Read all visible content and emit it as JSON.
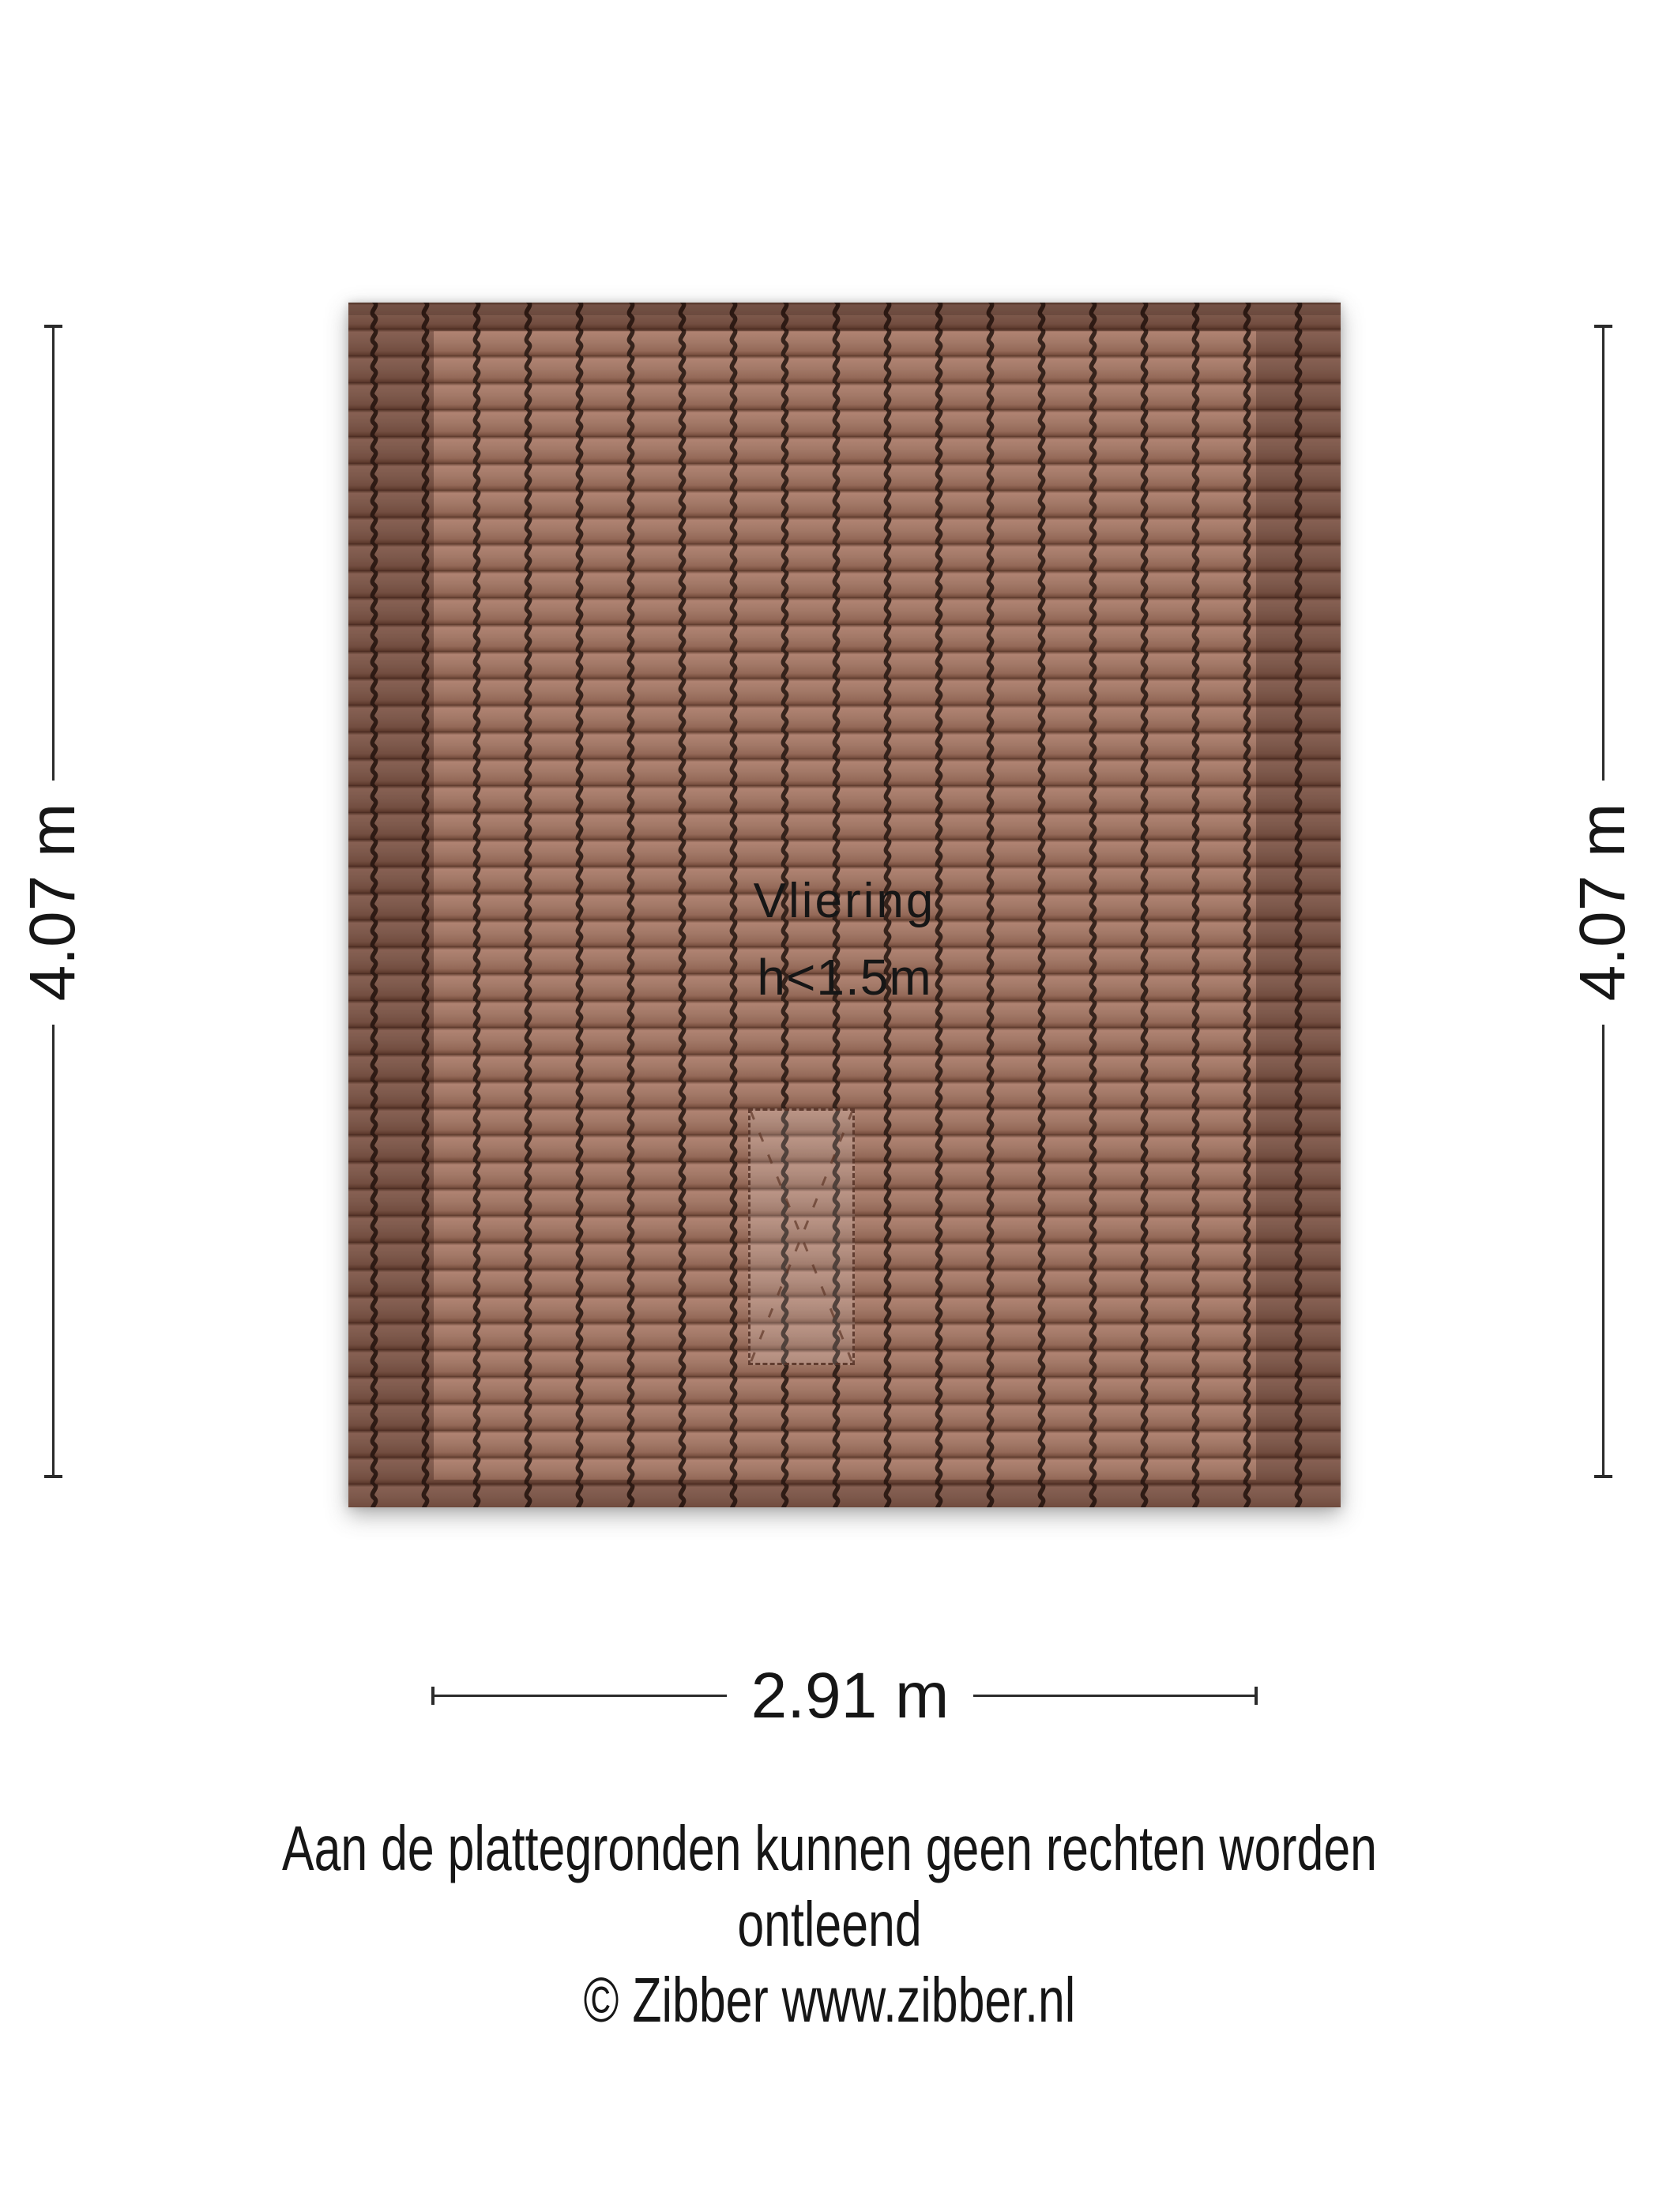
{
  "floorplan": {
    "room_label": "Vliering",
    "height_label": "h<1.5m",
    "dimensions": {
      "left": "4.07 m",
      "right": "4.07 m",
      "bottom": "2.91 m"
    },
    "colors": {
      "tile_base": "#a27867",
      "tile_highlight": "#b08372",
      "tile_shadow": "#5b392c",
      "tile_groove": "#2d1c16",
      "band_overlay": "rgba(28,8,2,0.28)",
      "hatch_stroke": "rgba(84,48,36,0.85)",
      "dimension_line": "#2b2b2b",
      "text": "#161616"
    }
  },
  "footer": {
    "disclaimer_line1": "Aan de plattegronden kunnen geen rechten worden ontleend",
    "disclaimer_line2": "© Zibber www.zibber.nl"
  }
}
